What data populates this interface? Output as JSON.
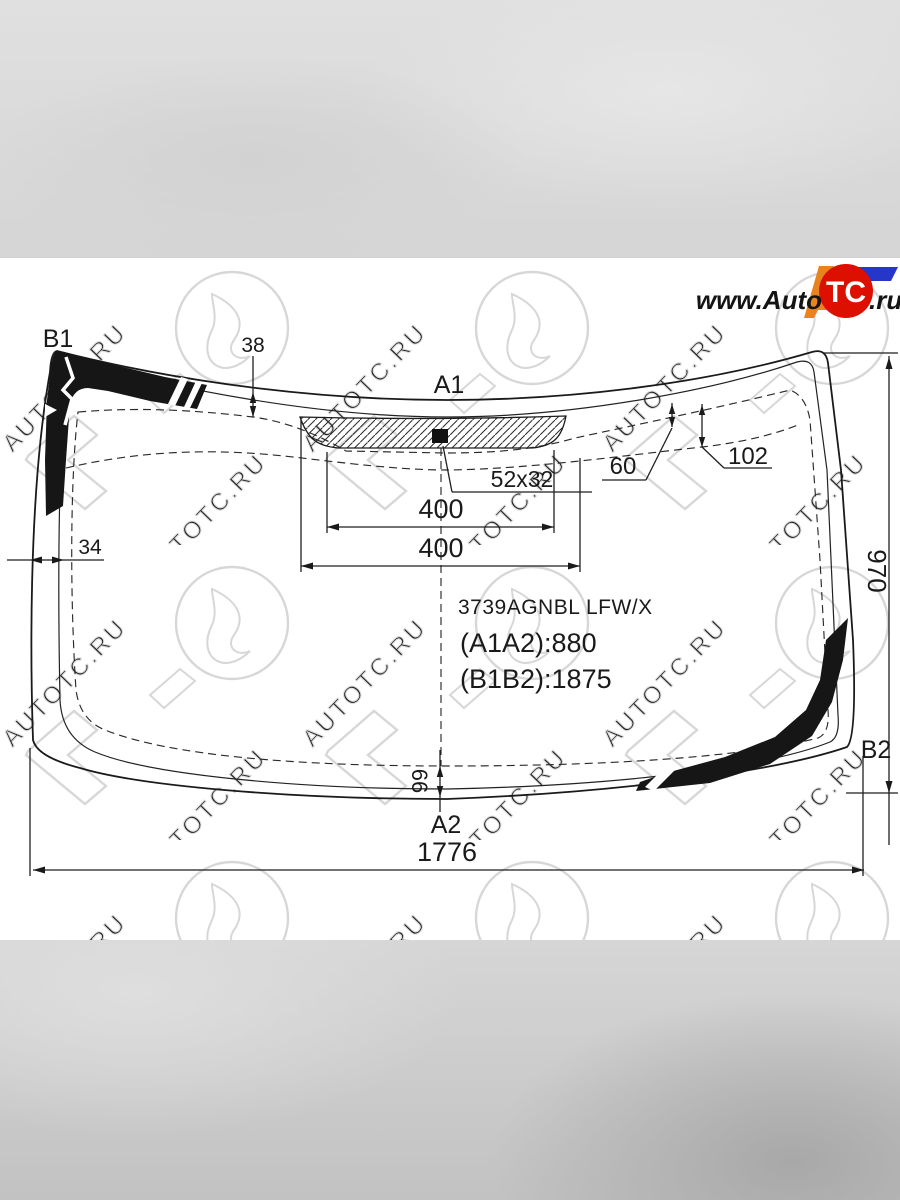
{
  "page": {
    "background": "#ffffff",
    "top_bar_color": "#dcdcdc",
    "bottom_bar_color": "#c9c9c9",
    "line_color": "#1a1a1a"
  },
  "logo": {
    "prefix": "www.Auto",
    "badge": "TC",
    "suffix": ".ru",
    "badge_color": "#dd1000",
    "orange_color": "#e8841c",
    "blue_color": "#2636c8"
  },
  "watermark": {
    "text": "AUTOTC.RU"
  },
  "part_info": {
    "part_number": "3739AGNBL LFW/X",
    "a_dim": "(A1A2):880",
    "b_dim": "(B1B2):1875"
  },
  "point_labels": {
    "top_left": "B1",
    "top_center": "A1",
    "right_bottom": "B2",
    "bottom_center": "A2"
  },
  "dimensions": {
    "top_edge_to_trim": "38",
    "sensor_small": "60",
    "sensor_large": "102",
    "mirror_base": "52x32",
    "width_upper": "400",
    "width_lower": "400",
    "side_edge_to_trim": "34",
    "right_height": "970",
    "bottom_edge_to_trim": "66",
    "bottom_width": "1776"
  }
}
